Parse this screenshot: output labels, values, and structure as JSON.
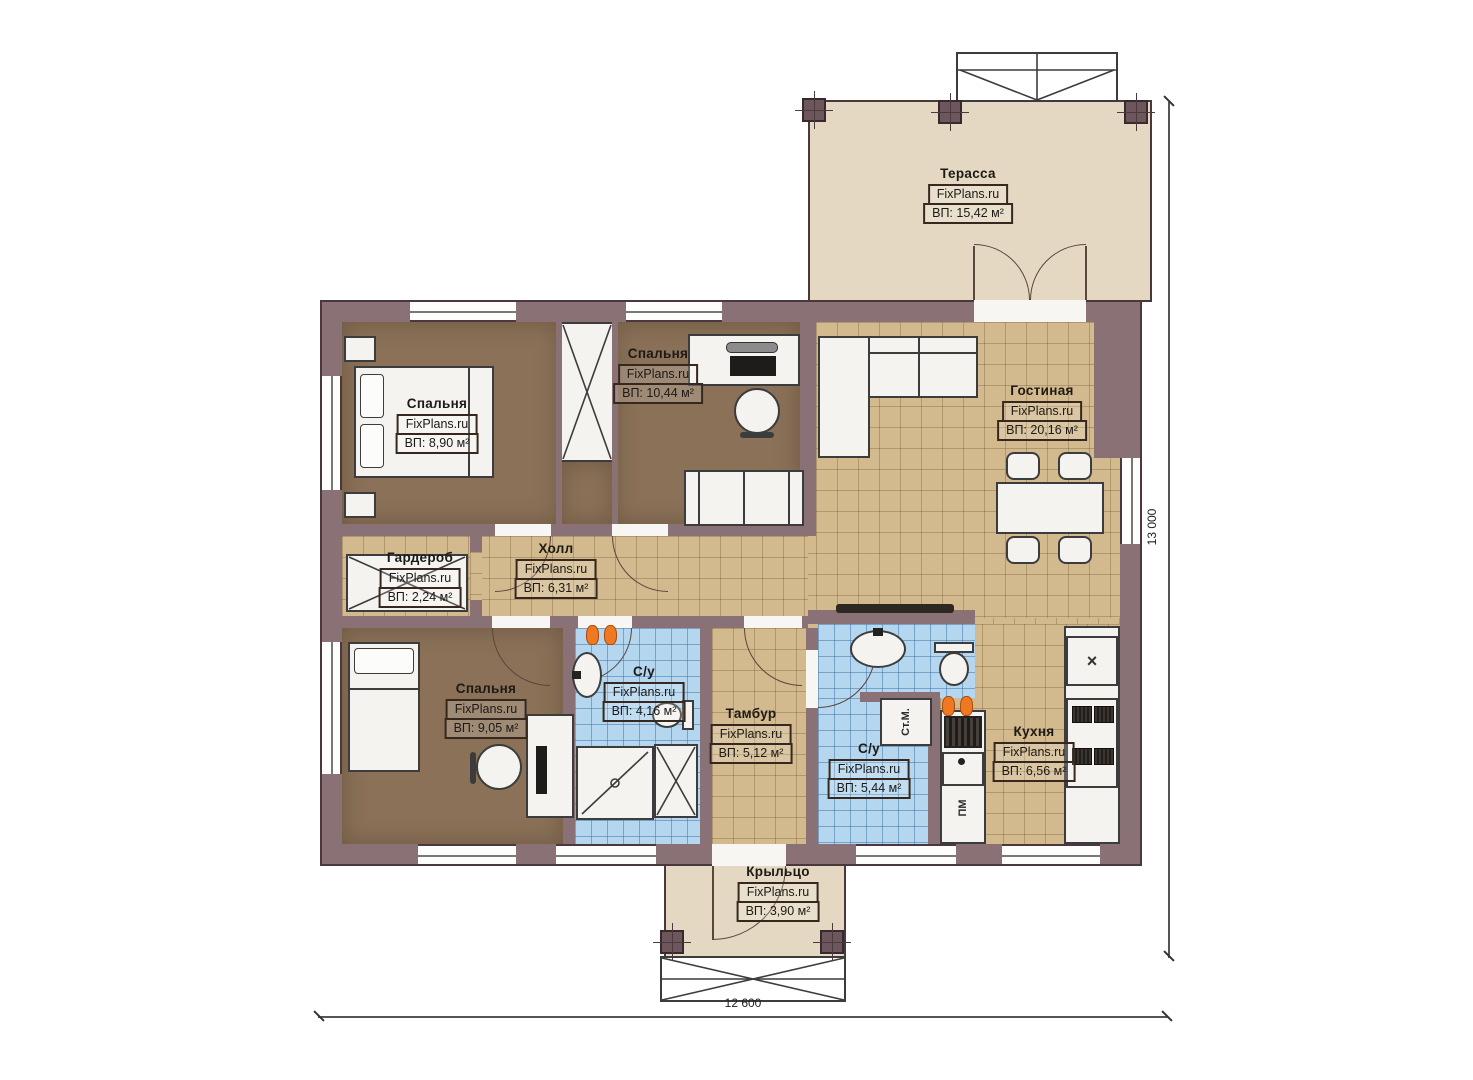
{
  "plan": {
    "rooms": {
      "terrace": {
        "name": "Терасса",
        "brand": "FixPlans.ru",
        "area": "ВП: 15,42 м²"
      },
      "bedroom1": {
        "name": "Спальня",
        "brand": "FixPlans.ru",
        "area": "ВП: 8,90 м²"
      },
      "bedroom2": {
        "name": "Спальня",
        "brand": "FixPlans.ru",
        "area": "ВП: 10,44 м²"
      },
      "living": {
        "name": "Гостиная",
        "brand": "FixPlans.ru",
        "area": "ВП: 20,16 м²"
      },
      "wardrobe": {
        "name": "Гардероб",
        "brand": "FixPlans.ru",
        "area": "ВП: 2,24 м²"
      },
      "hall": {
        "name": "Холл",
        "brand": "FixPlans.ru",
        "area": "ВП: 6,31 м²"
      },
      "bedroom3": {
        "name": "Спальня",
        "brand": "FixPlans.ru",
        "area": "ВП: 9,05 м²"
      },
      "bath1": {
        "name": "С/у",
        "brand": "FixPlans.ru",
        "area": "ВП: 4,16 м²"
      },
      "tambour": {
        "name": "Тамбур",
        "brand": "FixPlans.ru",
        "area": "ВП: 5,12 м²"
      },
      "bath2": {
        "name": "С/у",
        "brand": "FixPlans.ru",
        "area": "ВП: 5,44 м²"
      },
      "kitchen": {
        "name": "Кухня",
        "brand": "FixPlans.ru",
        "area": "ВП: 6,56 м²"
      },
      "porch": {
        "name": "Крыльцо",
        "brand": "FixPlans.ru",
        "area": "ВП: 3,90 м²"
      }
    },
    "appliances": {
      "washer": "Ст.М.",
      "dishwasher": "ПМ"
    },
    "icons": {
      "sink_cross": "×"
    },
    "dimensions": {
      "bottom": "12 600",
      "right": "13 000"
    },
    "colors": {
      "wall": "#897175",
      "wall_outline": "#4a383c",
      "terrace_floor": "#e5d8c3",
      "wood_floor": "#8a7158",
      "tile_tan": "#d2ba8e",
      "tile_blue": "#b4d6ef",
      "slippers": "#f07820"
    }
  }
}
